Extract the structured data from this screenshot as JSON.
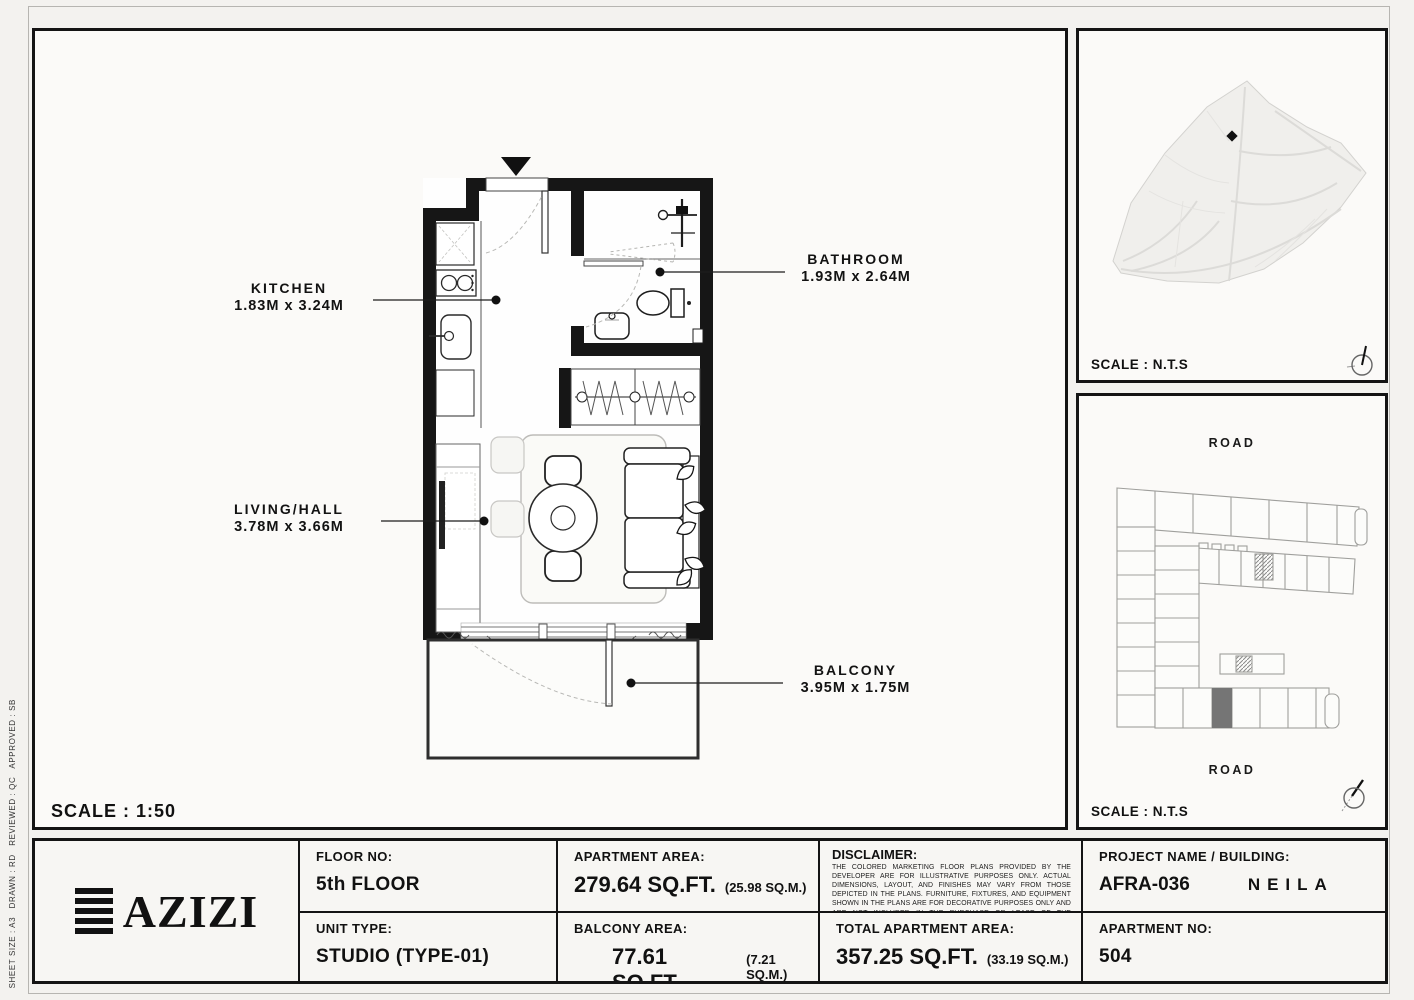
{
  "colors": {
    "paper": "#f3f2ef",
    "panel": "#fbfaf8",
    "line": "#141414",
    "light_line": "#d9d8d5",
    "highlight_unit": "#757575"
  },
  "plan": {
    "scale_label": "SCALE : 1:50",
    "rooms": [
      {
        "name": "KITCHEN",
        "dims": "1.83M x 3.24M"
      },
      {
        "name": "BATHROOM",
        "dims": "1.93M x 2.64M"
      },
      {
        "name": "LIVING/HALL",
        "dims": "3.78M x 3.66M"
      },
      {
        "name": "BALCONY",
        "dims": "3.95M x 1.75M"
      }
    ]
  },
  "side_panels": {
    "site_map": {
      "scale_label": "SCALE : N.T.S"
    },
    "key_plan": {
      "scale_label": "SCALE : N.T.S",
      "road_top": "ROAD",
      "road_bottom": "ROAD"
    }
  },
  "title_block": {
    "logo_text": "AZIZI",
    "floor_no": {
      "label": "FLOOR NO:",
      "value": "5th FLOOR"
    },
    "unit_type": {
      "label": "UNIT TYPE:",
      "value": "STUDIO (TYPE-01)"
    },
    "apartment_area": {
      "label": "APARTMENT AREA:",
      "value": "279.64 SQ.FT.",
      "metric": "(25.98 SQ.M.)"
    },
    "balcony_area": {
      "label": "BALCONY AREA:",
      "value": "77.61 SQ.FT.",
      "metric": "(7.21 SQ.M.)"
    },
    "disclaimer": {
      "label": "DISCLAIMER:",
      "text": "THE COLORED MARKETING FLOOR PLANS PROVIDED BY THE DEVELOPER ARE FOR ILLUSTRATIVE PURPOSES ONLY. ACTUAL DIMENSIONS, LAYOUT, AND FINISHES MAY VARY FROM THOSE DEPICTED IN THE PLANS. FURNITURE, FIXTURES, AND EQUIPMENT SHOWN IN THE PLANS ARE FOR DECORATIVE PURPOSES ONLY AND ARE NOT INCLUDED IN THE PURCHASE OR LEASE OF THE PROPERTY. THE DEVELOPER RESERVES THE RIGHT TO MAKE MODIFICATIONS, REVISIONS, AND CHANGES TO THE FLOOR PLANS, SPECIFICATIONS, AND FEATURES WITHOUT PRIOR NOTICE."
    },
    "total_area": {
      "label": "TOTAL APARTMENT AREA:",
      "value": "357.25 SQ.FT.",
      "metric": "(33.19 SQ.M.)"
    },
    "project": {
      "label": "PROJECT NAME / BUILDING:",
      "value": "AFRA-036",
      "building": "NEILA"
    },
    "apartment_no": {
      "label": "APARTMENT NO:",
      "value": "504"
    }
  },
  "sheet_info": {
    "text": "SHEET SIZE : A3   DRAWN : RD   REVIEWED : QC   APPROVED : SB"
  }
}
